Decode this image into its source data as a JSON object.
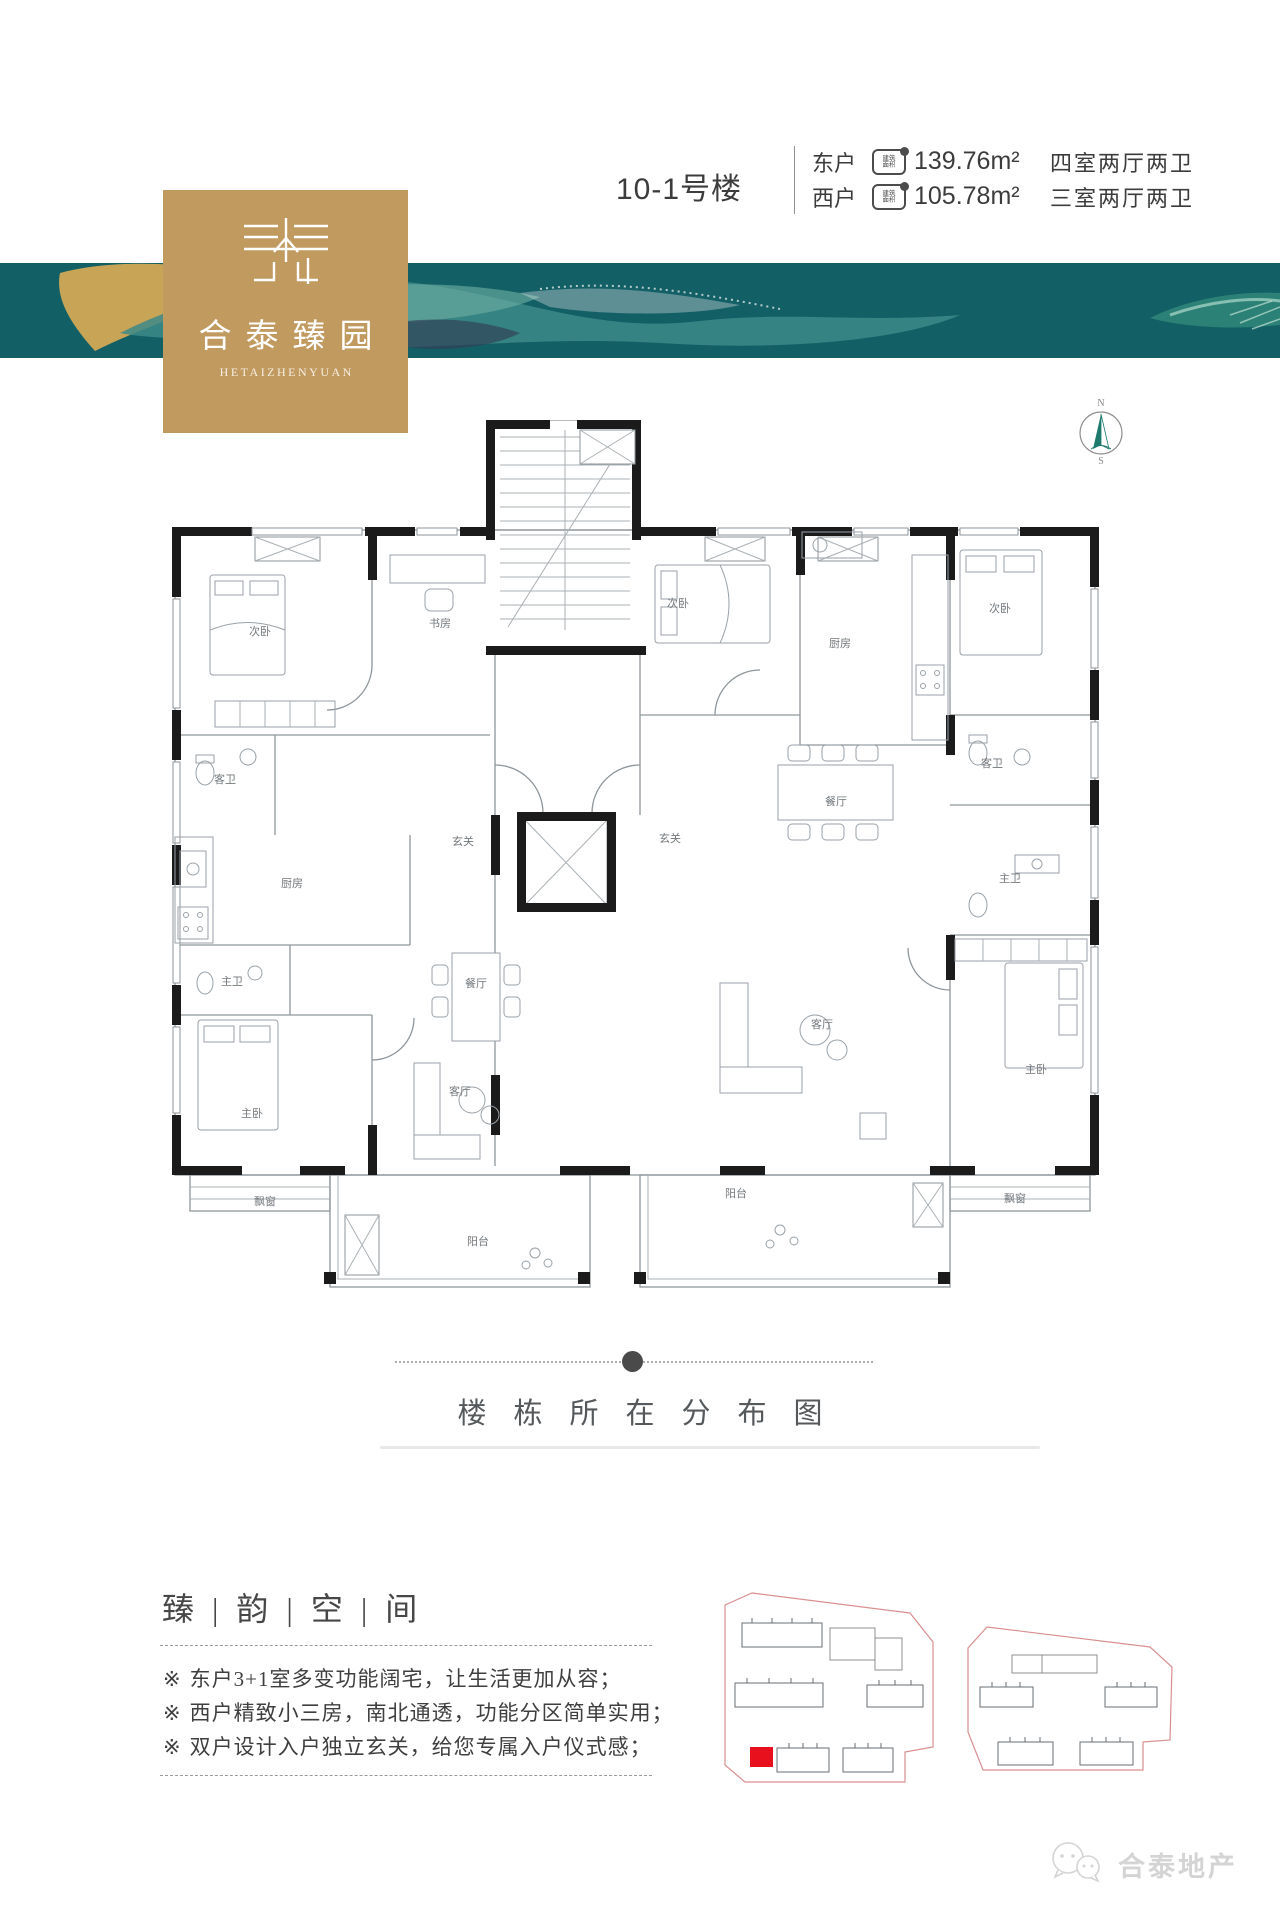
{
  "header": {
    "building_no": "10-1号楼",
    "units": [
      {
        "side": "东户",
        "area_badge": "建筑面积",
        "area": "139.76m²",
        "rooms": "四室两厅两卫"
      },
      {
        "side": "西户",
        "area_badge": "建筑面积",
        "area": "105.78m²",
        "rooms": "三室两厅两卫"
      }
    ]
  },
  "brand": {
    "logo_name": "合泰臻园",
    "logo_latin": "HETAIZHENYUAN",
    "footer_brand": "合泰地产"
  },
  "compass": {
    "north": "N",
    "south": "S"
  },
  "floorplan": {
    "rooms": [
      {
        "label": "次卧",
        "x": 100,
        "y": 120
      },
      {
        "label": "书房",
        "x": 280,
        "y": 112
      },
      {
        "label": "客卫",
        "x": 65,
        "y": 268
      },
      {
        "label": "厨房",
        "x": 132,
        "y": 372
      },
      {
        "label": "玄关",
        "x": 303,
        "y": 330
      },
      {
        "label": "餐厅",
        "x": 316,
        "y": 472
      },
      {
        "label": "主卫",
        "x": 72,
        "y": 470
      },
      {
        "label": "主卧",
        "x": 92,
        "y": 602
      },
      {
        "label": "客厅",
        "x": 300,
        "y": 580
      },
      {
        "label": "飘窗",
        "x": 105,
        "y": 690
      },
      {
        "label": "阳台",
        "x": 318,
        "y": 730
      },
      {
        "label": "次卧",
        "x": 518,
        "y": 92
      },
      {
        "label": "厨房",
        "x": 680,
        "y": 132
      },
      {
        "label": "次卧",
        "x": 840,
        "y": 97
      },
      {
        "label": "客卫",
        "x": 832,
        "y": 252
      },
      {
        "label": "餐厅",
        "x": 676,
        "y": 290
      },
      {
        "label": "玄关",
        "x": 510,
        "y": 327
      },
      {
        "label": "主卫",
        "x": 850,
        "y": 367
      },
      {
        "label": "客厅",
        "x": 662,
        "y": 513
      },
      {
        "label": "主卧",
        "x": 876,
        "y": 558
      },
      {
        "label": "飘窗",
        "x": 855,
        "y": 687
      },
      {
        "label": "阳台",
        "x": 576,
        "y": 682
      }
    ]
  },
  "distribution": {
    "title": "楼栋所在分布图"
  },
  "features": {
    "title": "臻 | 韵 | 空 | 间",
    "marker": "※",
    "items": [
      "东户3+1室多变功能阔宅，让生活更加从容；",
      "西户精致小三房，南北通透，功能分区简单实用；",
      "双户设计入户独立玄关，给您专属入户仪式感；"
    ]
  },
  "colors": {
    "banner_teal": "#135f66",
    "banner_teal_light": "#48938e",
    "gold": "#c19a60",
    "gold_splash": "#d2a855",
    "highlight_red": "#e8101d",
    "siteplan_outline": "#d98f8f",
    "wall_black": "#1b1b1b"
  }
}
